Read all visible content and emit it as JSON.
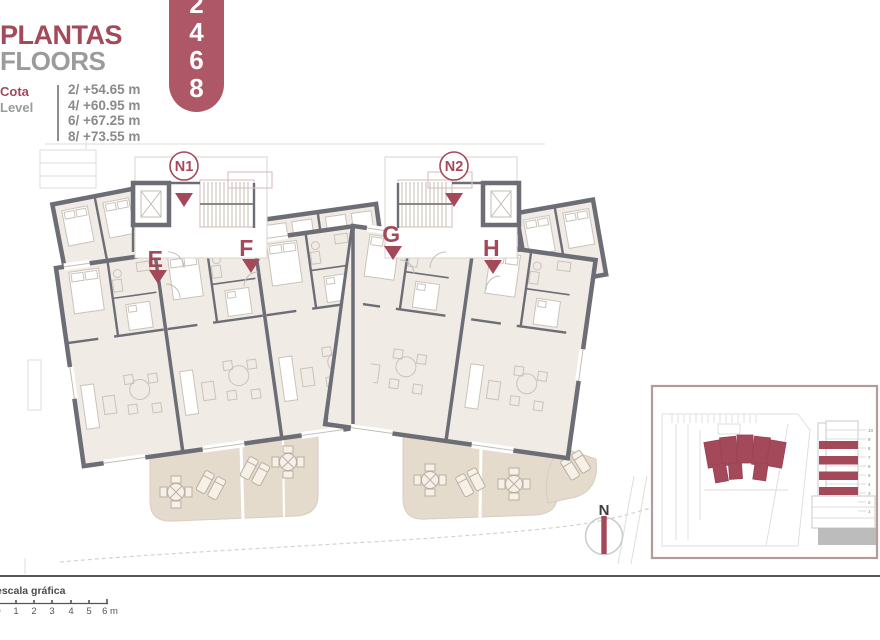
{
  "header": {
    "title_primary": "PLANTAS",
    "title_secondary": "FLOORS",
    "badge_digits": [
      "2",
      "4",
      "6",
      "8"
    ],
    "cota_label": "Cota",
    "level_label": "Level",
    "levels": [
      "2/ +54.65 m",
      "4/ +60.95 m",
      "6/ +67.25 m",
      "8/ +73.55 m"
    ]
  },
  "plan": {
    "core_labels": [
      "N1",
      "N2"
    ],
    "unit_labels": [
      "E",
      "F",
      "G",
      "H"
    ]
  },
  "north_label": "N",
  "scale_bar": {
    "label": "escala gráfica",
    "ticks": [
      "0",
      "1",
      "2",
      "3",
      "4",
      "5",
      "6 m"
    ]
  },
  "key_plan": {
    "section_floor_labels": [
      "10",
      "9",
      "8",
      "7",
      "6",
      "5",
      "4",
      "3",
      "2",
      "1"
    ]
  },
  "colors": {
    "accent": "#a4495a",
    "badge": "#ae5766",
    "wall": "#6d6d76",
    "interior": "#f1ebe5",
    "terrace": "#e5dbcd",
    "gray_text": "#8f8f8f",
    "keyplan_border": "#b59a9b"
  }
}
